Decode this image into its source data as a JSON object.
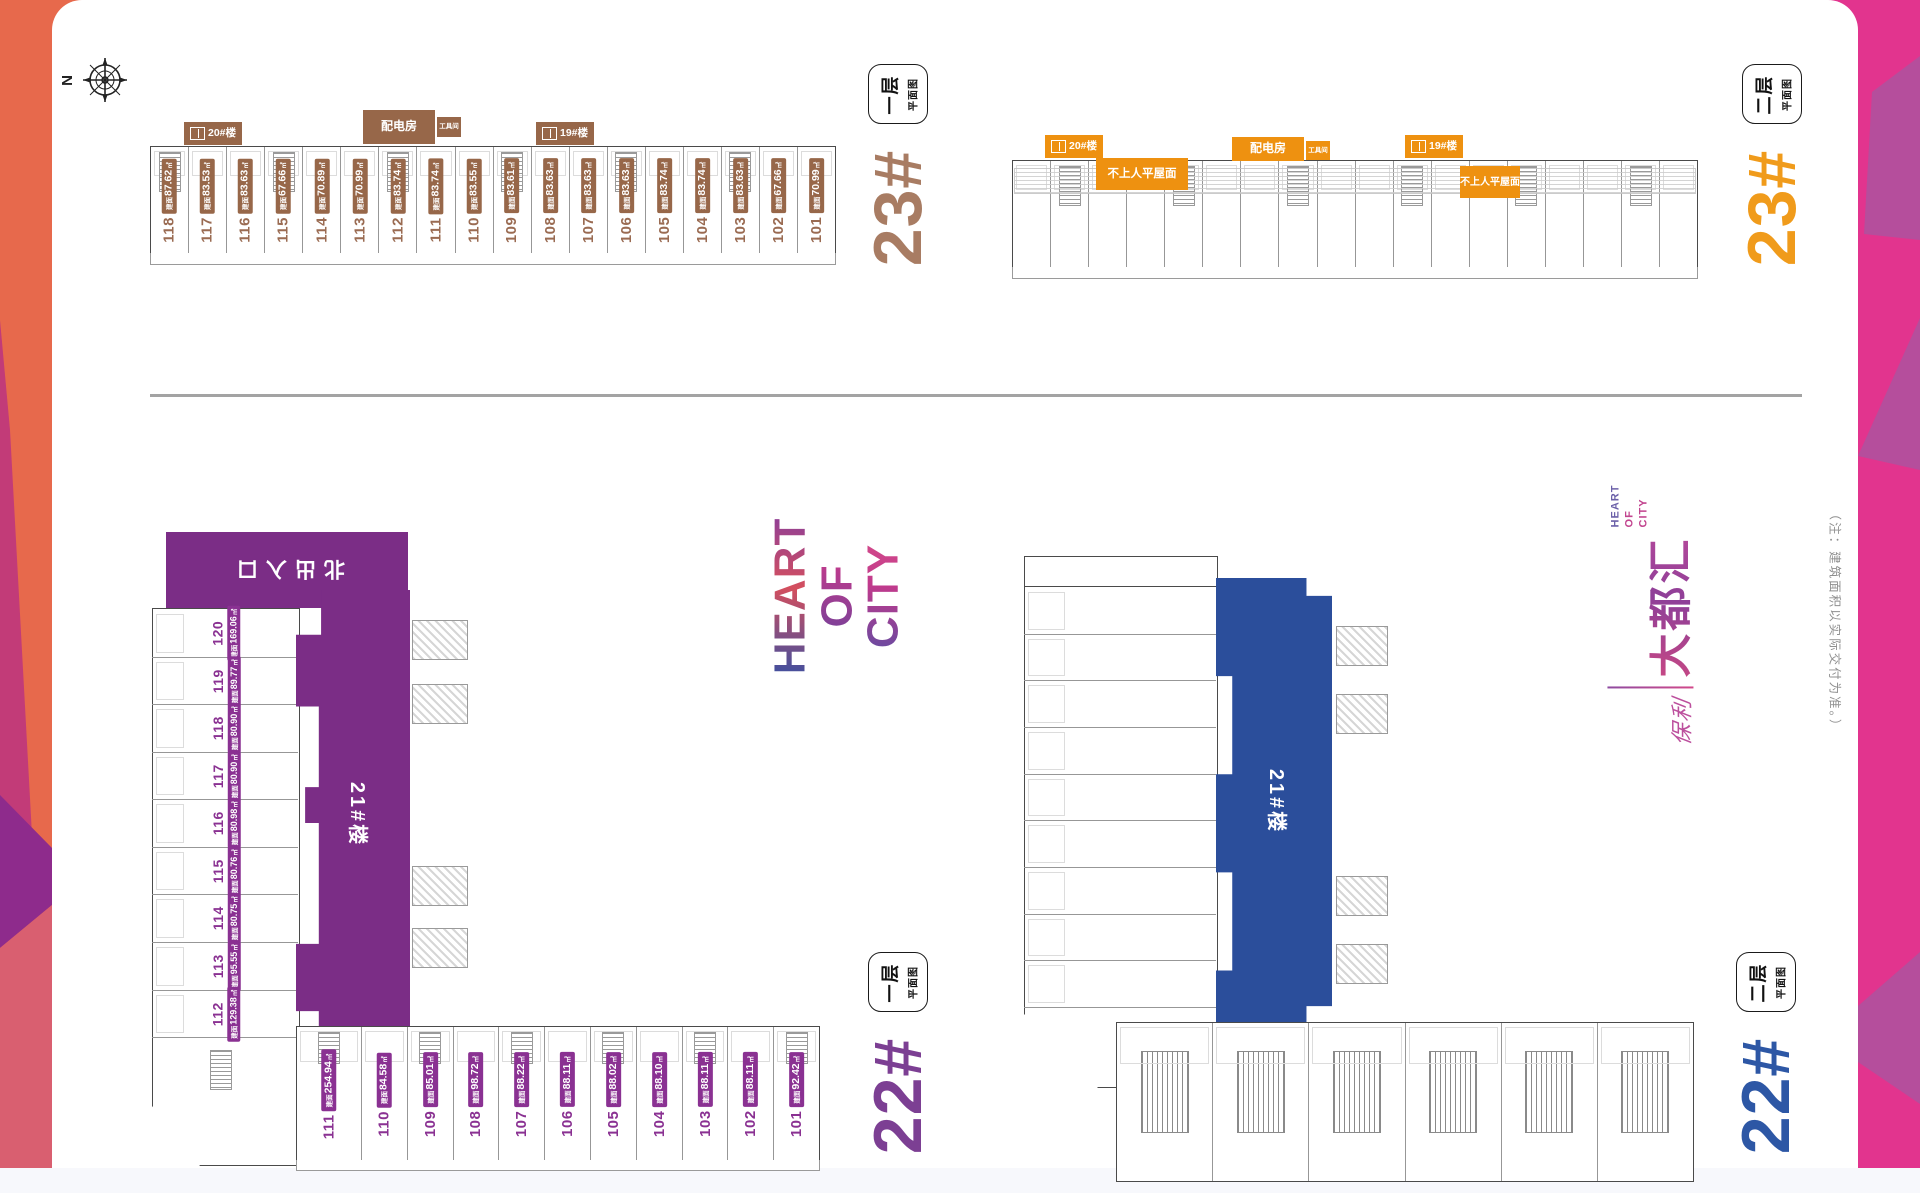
{
  "compass": {
    "label": "N"
  },
  "labels": {
    "area_prefix": "建面",
    "area_unit": "㎡"
  },
  "plans": {
    "b23_f1": {
      "building": "23#",
      "floor": "一层",
      "floor_type": "平面图",
      "annotations": {
        "b20": "20#楼",
        "power": "配电房",
        "tool": "工具间",
        "b19": "19#楼"
      },
      "units": [
        {
          "no": "118",
          "area": "87.62"
        },
        {
          "no": "117",
          "area": "83.53"
        },
        {
          "no": "116",
          "area": "83.63"
        },
        {
          "no": "115",
          "area": "67.66"
        },
        {
          "no": "114",
          "area": "70.89"
        },
        {
          "no": "113",
          "area": "70.99"
        },
        {
          "no": "112",
          "area": "83.74"
        },
        {
          "no": "111",
          "area": "83.74"
        },
        {
          "no": "110",
          "area": "83.55"
        },
        {
          "no": "109",
          "area": "83.61"
        },
        {
          "no": "108",
          "area": "83.63"
        },
        {
          "no": "107",
          "area": "83.63"
        },
        {
          "no": "106",
          "area": "83.63"
        },
        {
          "no": "105",
          "area": "83.74"
        },
        {
          "no": "104",
          "area": "83.74"
        },
        {
          "no": "103",
          "area": "83.63"
        },
        {
          "no": "102",
          "area": "67.66"
        },
        {
          "no": "101",
          "area": "70.99"
        }
      ]
    },
    "b23_f2": {
      "building": "23#",
      "floor": "二层",
      "floor_type": "平面图",
      "annotations": {
        "b20": "20#楼",
        "roof_left": "不上人平屋面",
        "power": "配电房",
        "tool": "工具间",
        "b19": "19#楼",
        "roof_right": "不上人平屋面"
      }
    },
    "b22_f1": {
      "building": "22#",
      "floor": "一层",
      "floor_type": "平面图",
      "entrance": "北出入口",
      "tower": "21#楼",
      "side_units": [
        {
          "no": "120",
          "area": "169.06"
        },
        {
          "no": "119",
          "area": "89.77"
        },
        {
          "no": "118",
          "area": "80.90"
        },
        {
          "no": "117",
          "area": "80.90"
        },
        {
          "no": "116",
          "area": "80.98"
        },
        {
          "no": "115",
          "area": "80.76"
        },
        {
          "no": "114",
          "area": "80.75"
        },
        {
          "no": "113",
          "area": "95.55"
        },
        {
          "no": "112",
          "area": "129.38"
        }
      ],
      "bottom_units": [
        {
          "no": "111",
          "area": "254.94"
        },
        {
          "no": "110",
          "area": "84.58"
        },
        {
          "no": "109",
          "area": "85.01"
        },
        {
          "no": "108",
          "area": "98.72"
        },
        {
          "no": "107",
          "area": "88.22"
        },
        {
          "no": "106",
          "area": "88.11"
        },
        {
          "no": "105",
          "area": "88.02"
        },
        {
          "no": "104",
          "area": "88.10"
        },
        {
          "no": "103",
          "area": "88.11"
        },
        {
          "no": "102",
          "area": "88.11"
        },
        {
          "no": "101",
          "area": "92.42"
        }
      ]
    },
    "b22_f2": {
      "building": "22#",
      "floor": "二层",
      "floor_type": "平面图",
      "tower": "21#楼"
    }
  },
  "branding": {
    "heart_lines": [
      "HEART",
      "OF",
      "CITY"
    ],
    "logo": {
      "script": "保利",
      "name": "大都汇",
      "en_lines": [
        "HEART",
        "OF",
        "CITY"
      ]
    },
    "note": "（注：建筑面积以实际交付为准。）"
  },
  "colors": {
    "brown": "#976749",
    "orange": "#EE9110",
    "purple": "#7B2D86",
    "chip_purple": "#8A3192",
    "blue": "#2B4E9B",
    "border_orange": "#E7694C",
    "border_pink": "#D95F70",
    "border_magenta": "#E2348E",
    "accent_purple": "#8E2B8C"
  }
}
